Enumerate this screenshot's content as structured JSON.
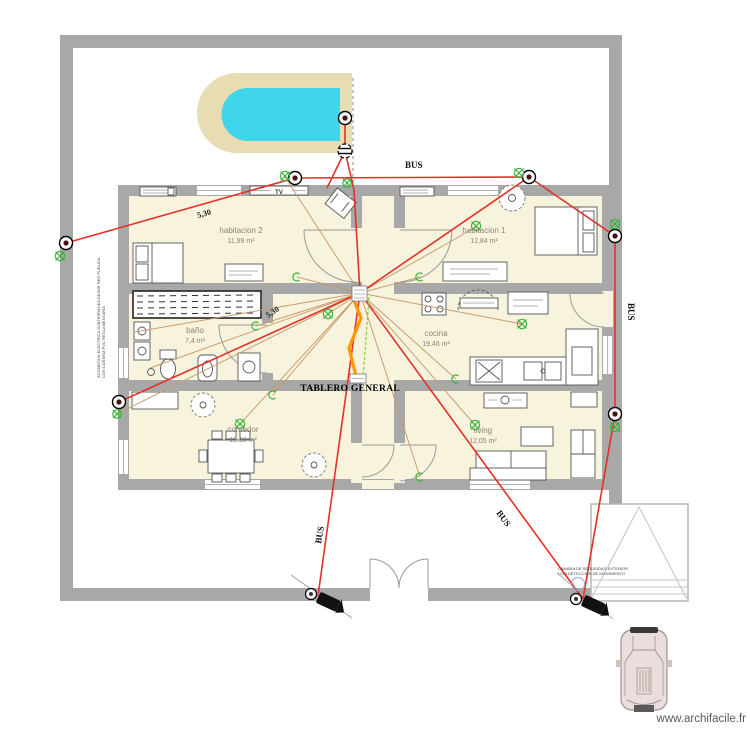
{
  "watermark": "www.archifacile.fr",
  "labels": {
    "panel": "TABLERO GENERAL",
    "bus": "BUS",
    "tv": "TV",
    "dim1": "5,30",
    "dim2": "5,30"
  },
  "rooms": [
    {
      "name": "habitacion 2",
      "area": "11,99 m²"
    },
    {
      "name": "habitacion 1",
      "area": "12,84 m²"
    },
    {
      "name": "baño",
      "area": "7,4 m²"
    },
    {
      "name": "cocina",
      "area": "19,46 m²"
    },
    {
      "name": "comedor",
      "area": "12,18 m²"
    },
    {
      "name": "living",
      "area": "12,05 m²"
    }
  ],
  "notes": {
    "left_line1": "ACOMETIDA ELECTRICA SUBTERRANEA DESDE RED PUBLICA",
    "left_line2": "CON CAÑERIA PVC REGLAMENTARIA",
    "camera_line1": "CAMARA DE SEGURIDAD EXTERIOR",
    "camera_line2": "CON DETECCION DE MOVIMIENTO"
  },
  "colors": {
    "wall": "#a8a8a8",
    "floor": "#f8f3dd",
    "pool_water": "#3fd5ea",
    "pool_deck": "#e8ddb2",
    "bus_line": "#e33127",
    "cable_line": "#c79a6b",
    "panel_line": "#ff9800",
    "symbol_green": "#3bb33b"
  }
}
